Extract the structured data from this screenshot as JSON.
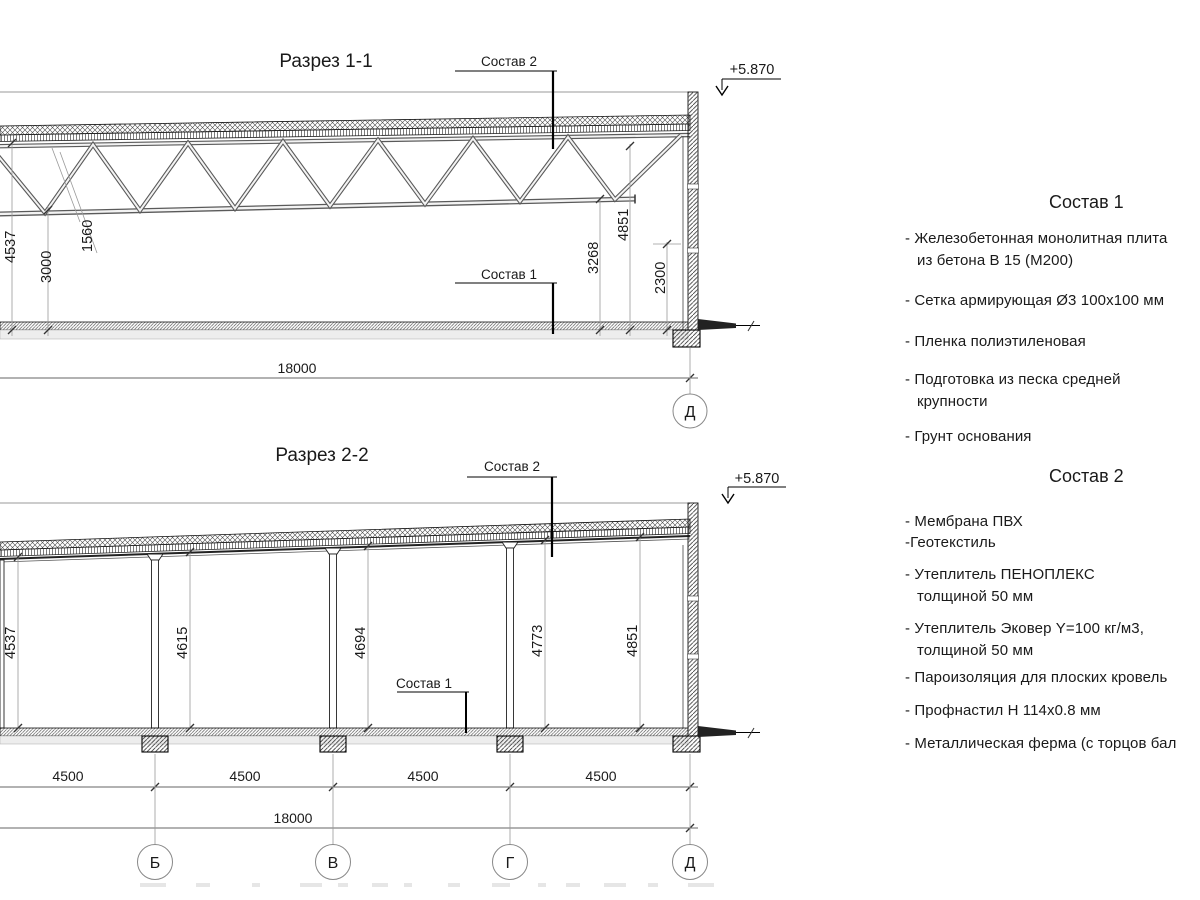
{
  "section1": {
    "title": "Разрез 1-1",
    "callout_roof": "Состав 2",
    "callout_floor": "Состав 1",
    "elevation": "+5.870",
    "total_width": "18000",
    "axis_label": "Д",
    "dims": {
      "overall_height_left": "4537",
      "clear_height_left": "3000",
      "truss_depth": "1560",
      "clear_height_right": "3268",
      "overall_height_right": "4851",
      "opening_height": "2300"
    }
  },
  "section2": {
    "title": "Разрез 2-2",
    "callout_roof": "Состав 2",
    "callout_floor": "Состав 1",
    "elevation": "+5.870",
    "total_width": "18000",
    "bay_width": "4500",
    "heights": [
      "4537",
      "4615",
      "4694",
      "4773",
      "4851"
    ],
    "axes": [
      "Б",
      "В",
      "Г",
      "Д"
    ]
  },
  "composition1": {
    "title": "Состав 1",
    "items": [
      [
        "- Железобетонная  монолитная плита",
        "из бетона В 15 (М200)"
      ],
      [
        "- Сетка армирующая Ø3 100х100 мм"
      ],
      [
        "- Пленка полиэтиленовая"
      ],
      [
        "- Подготовка из песка средней",
        "крупности"
      ],
      [
        "- Грунт основания"
      ]
    ]
  },
  "composition2": {
    "title": "Состав 2",
    "items": [
      [
        "- Мембрана ПВХ"
      ],
      [
        "-Геотекстиль"
      ],
      [
        "- Утеплитель ПЕНОПЛЕКС",
        "толщиной 50 мм"
      ],
      [
        "- Утеплитель Эковер Y=100 кг/м3,",
        "толщиной 50 мм"
      ],
      [
        "- Пароизоляция для плоских кровель"
      ],
      [
        "- Профнастил Н 114х0.8 мм"
      ],
      [
        "- Металлическая ферма (с торцов бал"
      ]
    ]
  },
  "colors": {
    "background": "#ffffff",
    "line": "#1a1a1a"
  }
}
